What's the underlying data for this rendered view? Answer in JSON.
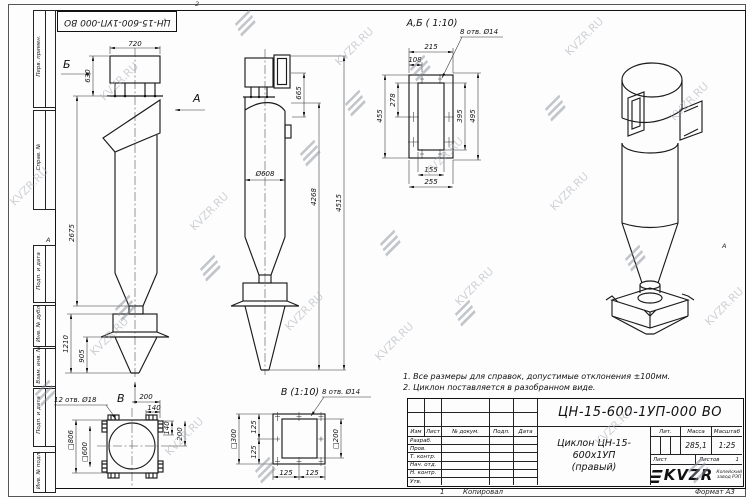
{
  "watermark": {
    "text": "KVZR.RU"
  },
  "frame": {
    "stamp": "ЦН-15-600-1УП-000 ВО",
    "side_labels": [
      "Перв. примен.",
      "Справ. №",
      "Подп. и дата",
      "Инв. № дубл.",
      "Взам. инв. №",
      "Подп. и дата",
      "Инв. № подл."
    ],
    "zone_top": "2",
    "zone_left": "А",
    "zone_right": "А"
  },
  "views": {
    "front": {
      "dim_width_top": "720",
      "dim_inlet": "630",
      "dim_body": "2675",
      "dim_bunker": "1210",
      "dim_cone": "905",
      "arrow_a": "А",
      "arrow_b": "Б",
      "arrow_v": "В"
    },
    "side": {
      "dim_outlet": "665",
      "dim_diameter": "Ø608",
      "dim_h1": "4268",
      "dim_h2": "4515"
    },
    "section_ab": {
      "title": "А,Б ( 1:10)",
      "holes_label": "8 отв. Ø14",
      "dim_215": "215",
      "dim_108": "108",
      "dim_278": "278",
      "dim_455": "455",
      "dim_395": "395",
      "dim_495": "495",
      "dim_155": "155",
      "dim_255": "255"
    },
    "view_v": {
      "title": "В (1:10)",
      "holes_label": "8 отв. Ø14",
      "dim_outer": "□300",
      "dim_inner": "□200",
      "dim_q1": "125",
      "dim_q2": "125",
      "dim_q3": "125",
      "dim_q4": "125"
    },
    "base": {
      "holes_label": "12 отв. Ø18",
      "dim_200_top": "200",
      "dim_140_top": "140",
      "dim_140_right": "140",
      "dim_200_right": "200",
      "dim_outer": "□806",
      "dim_inner": "□600"
    }
  },
  "notes": {
    "line1": "1. Все размеры для справок, допустимые отклонения ±100мм.",
    "line2": "2. Циклон поставляется в разобранном виде."
  },
  "title_block": {
    "doc_number": "ЦН-15-600-1УП-000 ВО",
    "name_line1": "Циклон ЦН-15-600х1УП",
    "name_line2": "(правый)",
    "col_izm": "Изм",
    "col_list": "Лист",
    "col_doc": "№ докум.",
    "col_podp": "Подп.",
    "col_data": "Дата",
    "row_razrab": "Разраб.",
    "row_prov": "Пров.",
    "row_tkontr": "Т. контр.",
    "row_nachotd": "Нач. отд.",
    "row_nkontr": "Н. контр.",
    "row_utv": "Утв.",
    "lit_label": "Лит.",
    "mass_label": "Масса",
    "scale_label": "Масштаб",
    "mass_value": "285,1",
    "scale_value": "1:25",
    "sheet_label": "Лист",
    "sheets_label": "Листов",
    "sheets_value": "1",
    "logo_text": "KVZR",
    "logo_sub1": "Копейский",
    "logo_sub2": "завод РЭП",
    "footer_num": "1",
    "footer_copy": "Копировал",
    "footer_format": "Формат А3"
  }
}
